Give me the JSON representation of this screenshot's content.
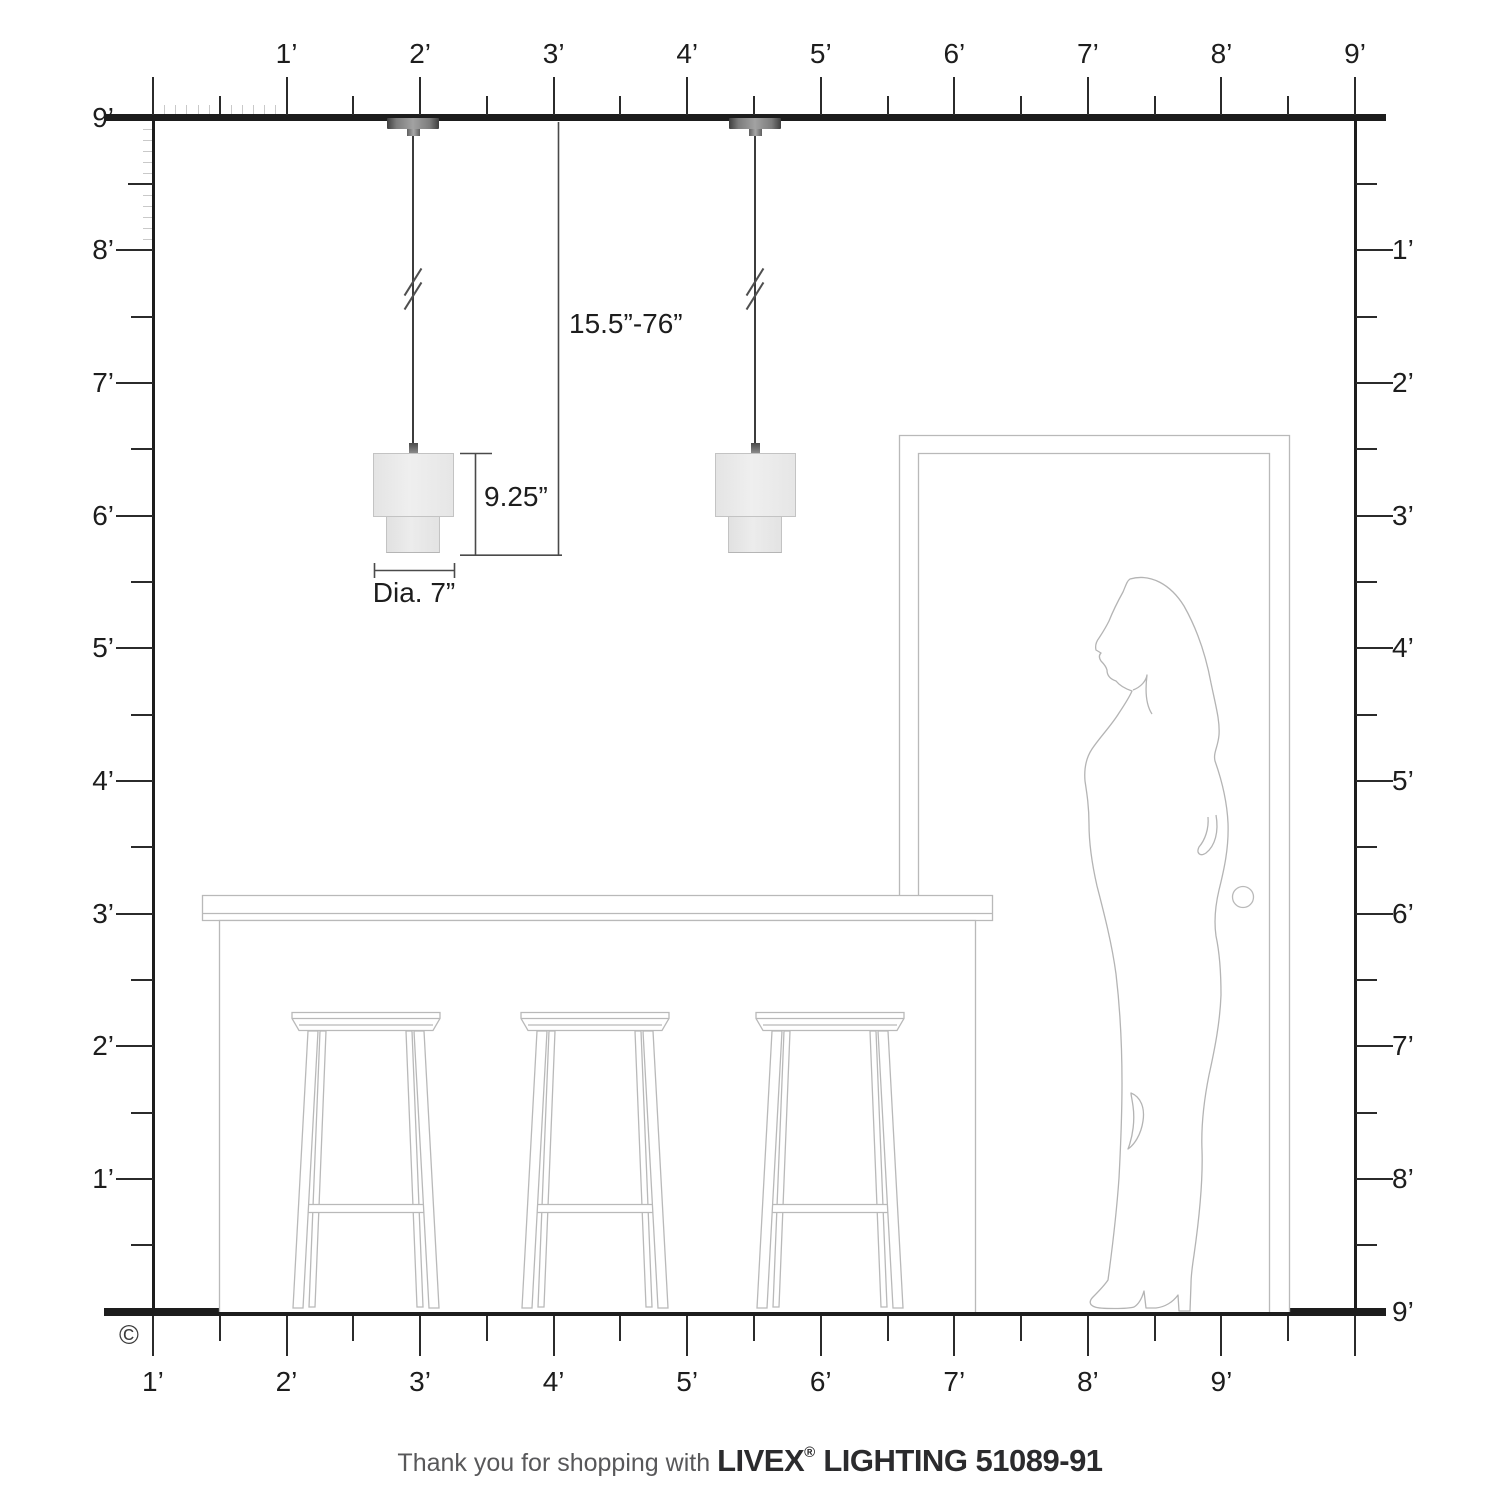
{
  "rulers": {
    "top": {
      "labels": [
        "1’",
        "2’",
        "3’",
        "4’",
        "5’",
        "6’",
        "7’",
        "8’",
        "9’"
      ]
    },
    "bottom": {
      "labels": [
        "9’",
        "8’",
        "7’",
        "6’",
        "5’",
        "4’",
        "3’",
        "2’",
        "1’"
      ]
    },
    "left": {
      "labels": [
        "9’",
        "8’",
        "7’",
        "6’",
        "5’",
        "4’",
        "3’",
        "2’",
        "1’"
      ]
    },
    "right": {
      "labels": [
        "1’",
        "2’",
        "3’",
        "4’",
        "5’",
        "6’",
        "7’",
        "8’",
        "9’"
      ]
    }
  },
  "dimensions": {
    "drop": "15.5”-76”",
    "height": "9.25”",
    "diameter": "Dia. 7”"
  },
  "footer": {
    "prefix": "Thank you for shopping with ",
    "brand": "LIVEX",
    "registered": "®",
    "suffix": " LIGHTING 51089-91"
  },
  "copyright": "©",
  "colors": {
    "structure_line": "#1d1d1d",
    "tick": "#2b2b2b",
    "inch_tick": "#c9c9c9",
    "furniture_outline": "#b9b9b9",
    "dimension_line": "#4a4a4a",
    "label_text": "#1d1d1d",
    "shade_fill": "#e9e9e9",
    "shade_border": "#c3c3c3",
    "canopy_dark": "#3e3e3e",
    "cord": "#3c3c3c",
    "footer_light": "#58585a",
    "footer_bold": "#2b2b2d"
  }
}
